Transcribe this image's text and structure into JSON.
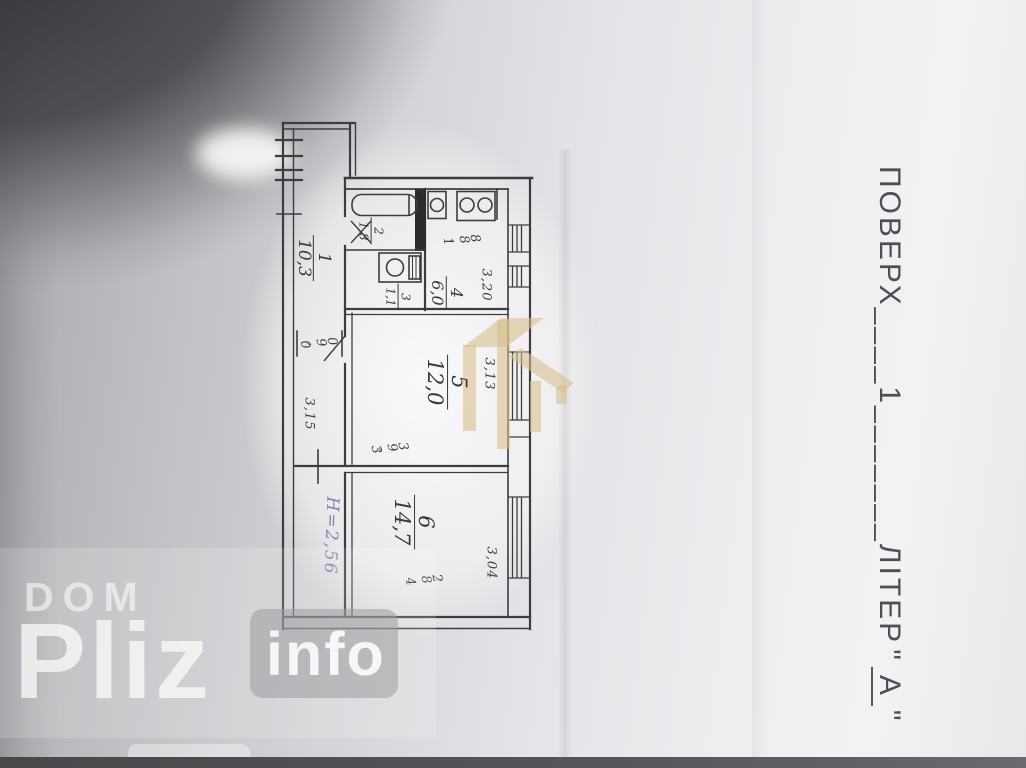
{
  "photo": {
    "floor_title": {
      "word1": "ПОВЕРХ",
      "blank1": "____",
      "number": "1",
      "blank2": "_______",
      "word2": "ЛІТЕР",
      "quote_open": "\"",
      "letter": "А",
      "quote_close": "\""
    },
    "floor_plan": {
      "room_labels": [
        {
          "number": "1",
          "area": "10,3"
        },
        {
          "number": "2",
          "area": "1,8"
        },
        {
          "number": "3",
          "area": "1,1"
        },
        {
          "number": "4",
          "area": "6,0"
        },
        {
          "number": "5",
          "area": "12,0"
        },
        {
          "number": "6",
          "area": "14,7"
        }
      ],
      "dimensions": {
        "kitchen_width": "1,88",
        "kitchen_depth": "3,20",
        "hall_door_width": "0,90",
        "room5_right": "3,13",
        "room5_left": "3,15",
        "room5_bottom": "3,93",
        "room6_right": "3,04",
        "room6_bottom": "4,82"
      },
      "ceiling_height_note": "H=2,56"
    },
    "watermarks": {
      "brand_top": "DOM",
      "brand_main": "Pliz",
      "brand_suffix": "info"
    },
    "colors": {
      "logo_tan": "#d9c18e",
      "pen_purple": "#8282ac",
      "plan_ink": "#3e3c40",
      "title_ink": "#4e4e55"
    }
  }
}
